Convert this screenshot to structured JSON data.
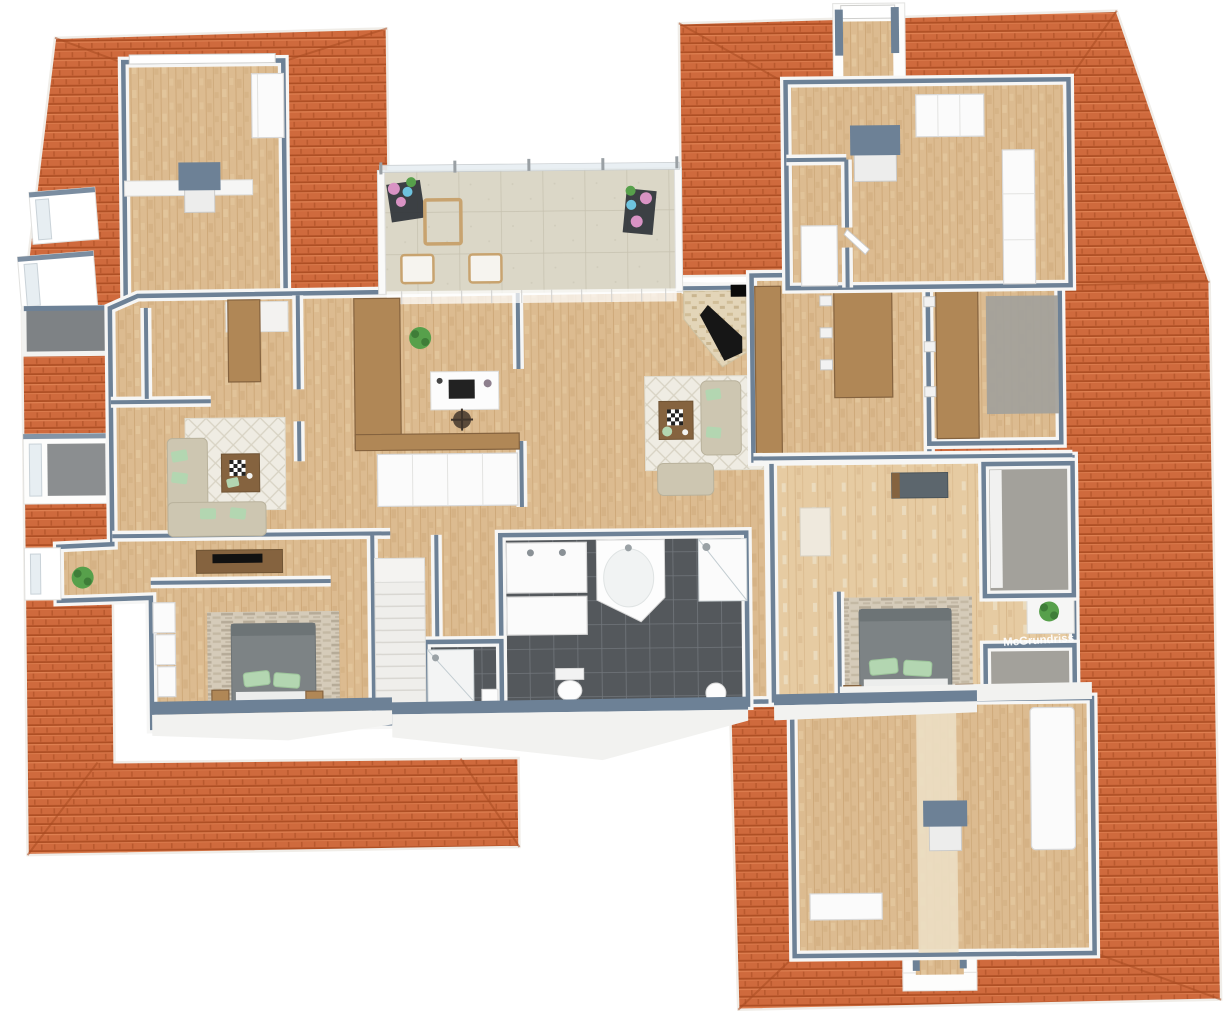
{
  "meta": {
    "type": "3d-floorplan-render",
    "watermark": "McGrundriss"
  },
  "palette": {
    "roof": "#cf6a3d",
    "roof_dark": "#a84a20",
    "roof_light": "#e68a5c",
    "wall": "#6d8196",
    "wall_white": "#f4f4f3",
    "wood": "#dcbb90",
    "wood_light": "#e6cba2",
    "wood_pale": "#ecdfc4",
    "wood_grain": "#c09763",
    "tile": "#54585c",
    "tile_grout": "#71767b",
    "terrace": "#dbd7c7",
    "terrace_grout": "#c6c1af",
    "rug": "#efece3",
    "rug_line": "#d8d3c4",
    "stone_a": "#d5cbb9",
    "stone_b": "#b1a692",
    "stone_c": "#c4b9a4",
    "carpet": "#a3a19b",
    "sofa": "#cdc6b1",
    "pillow": "#b3d6b1",
    "bed": "#7d8385",
    "furn_wood": "#b08756",
    "furn_dark": "#85633f",
    "glass": "#e7eef2",
    "plant": "#57a04b",
    "flower_pink": "#d993c4",
    "flower_blue": "#6ec3de",
    "firebox": "#161616"
  }
}
